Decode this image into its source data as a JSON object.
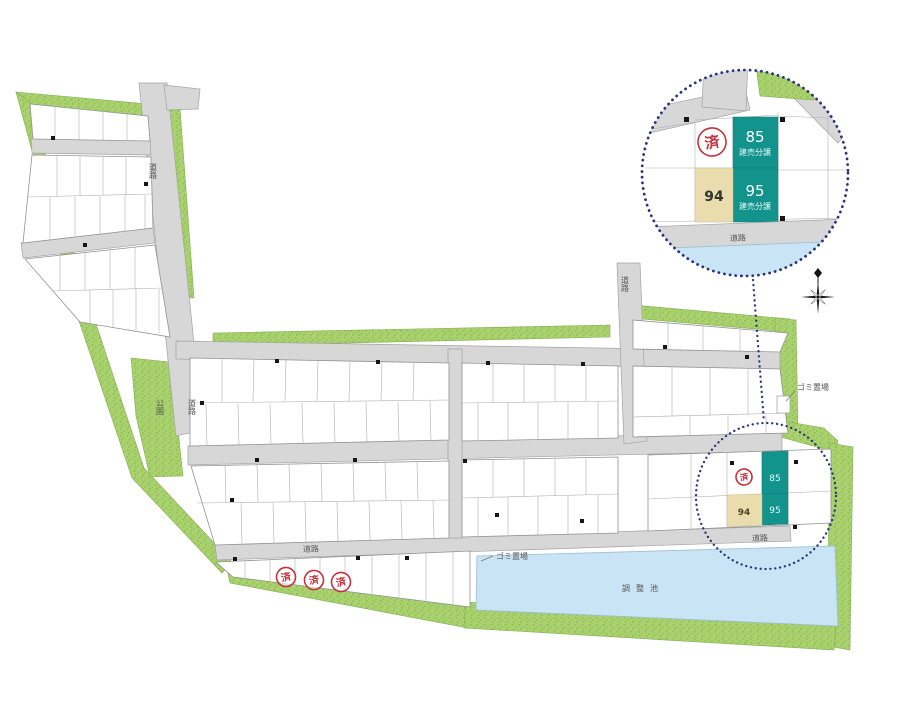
{
  "site_plan": {
    "labels": {
      "road": "道路",
      "park": "公園",
      "pond": "調整池",
      "garbage": "ゴミ置場",
      "sold_stamp": "済"
    },
    "plots": {
      "p85": "85",
      "p94": "94",
      "p95": "95",
      "sale_type": "建売分譲"
    },
    "colors": {
      "for_sale_teal": "#12948c",
      "reserved_beige": "#e9ddae",
      "greenery": "#a9d16e",
      "road_gray": "#d7d7d8",
      "pond_blue": "#c9e4f4",
      "sold_red": "#c4323e",
      "highlight_navy": "#2a357e"
    }
  }
}
